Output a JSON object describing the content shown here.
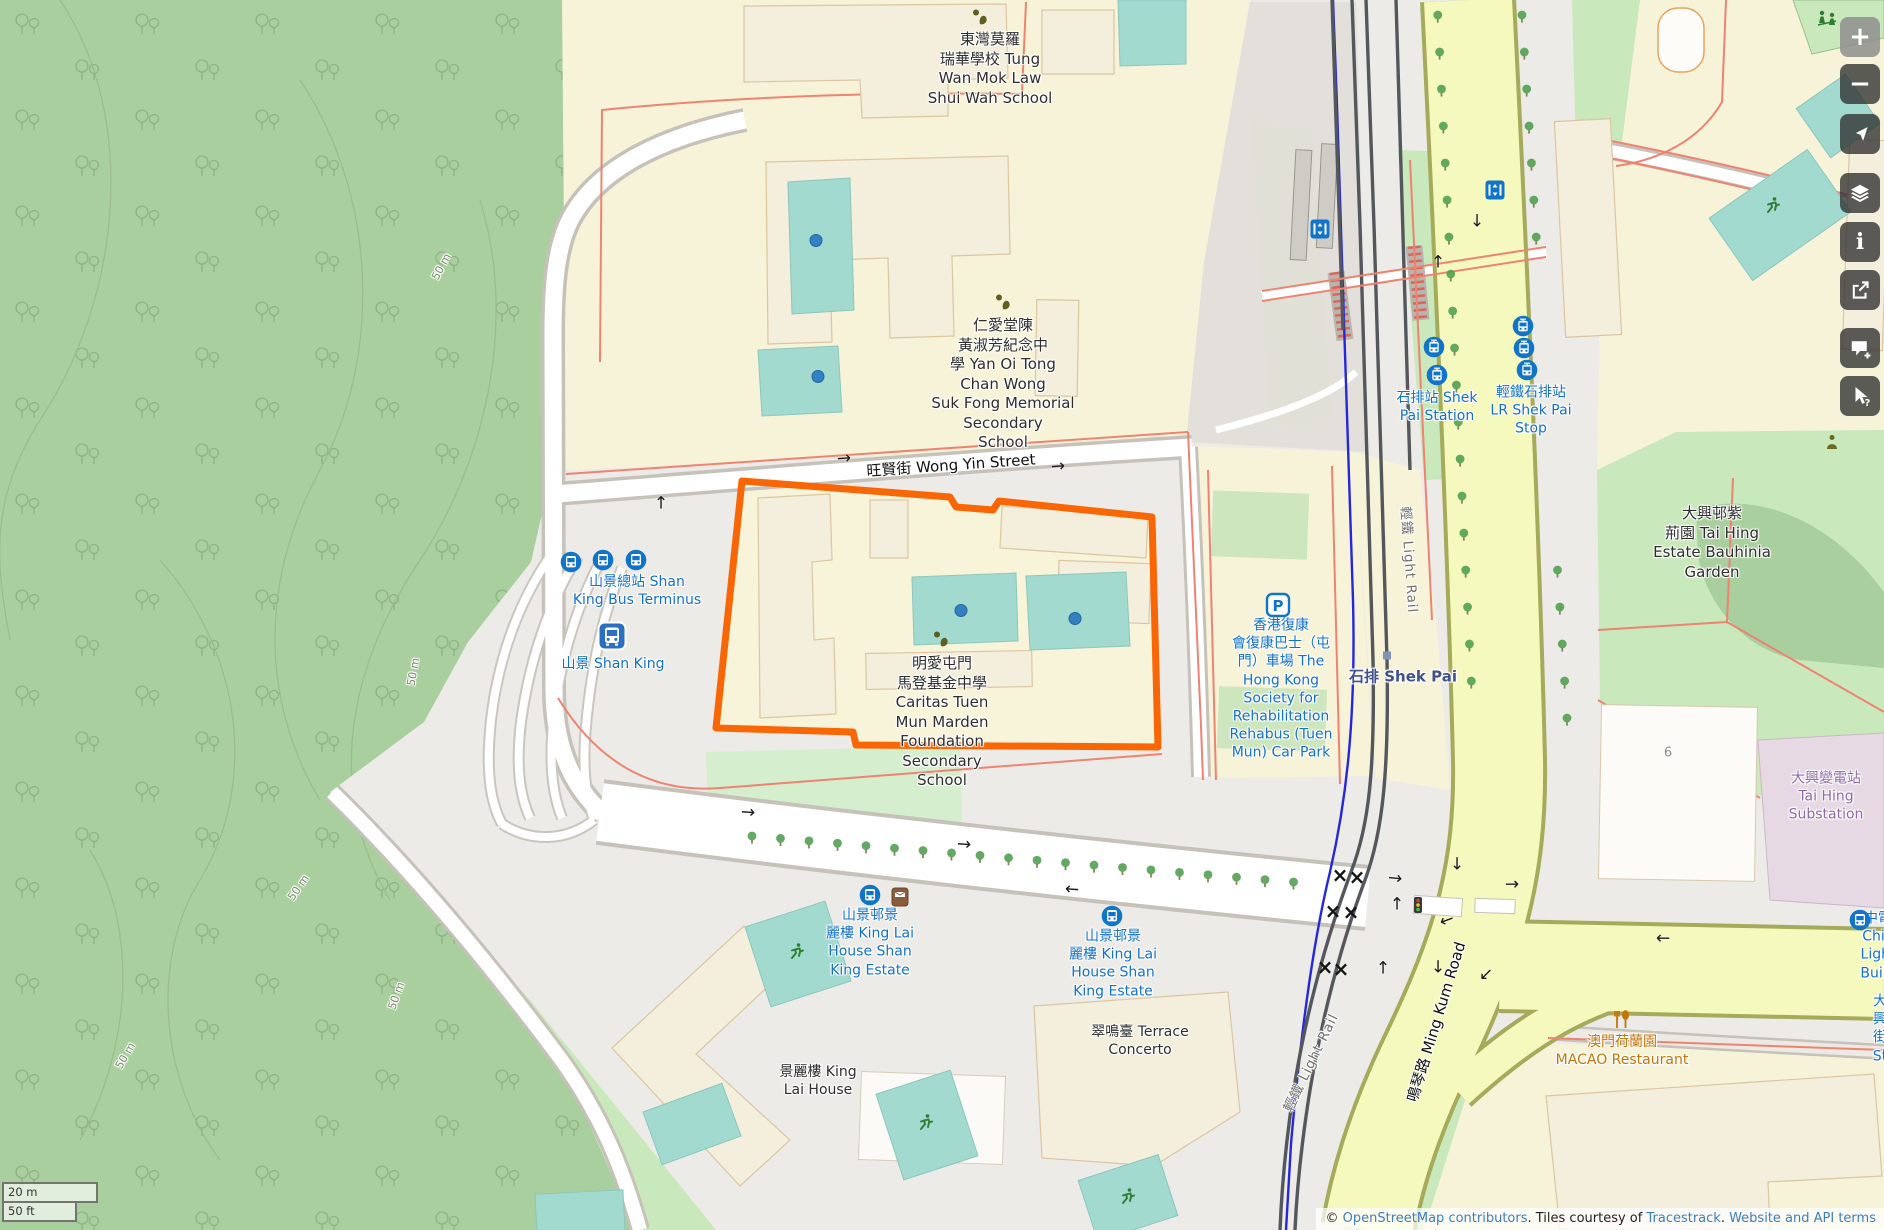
{
  "map": {
    "selection_color": "#f96605",
    "scale_bar": {
      "metric": "20 m",
      "imperial": "50 ft"
    },
    "attribution": {
      "prefix": "© ",
      "osm_link": "OpenStreetMap contributors",
      "middle": ". Tiles courtesy of ",
      "tracestrack_link": "Tracestrack",
      "period": ". ",
      "terms_link": "Website and API terms"
    },
    "labels": [
      {
        "n": "tung-wan-school",
        "t": "東灣莫羅\n瑞華學校 Tung\nWan Mok Law\nShui Wah School",
        "x": 990,
        "y": 69,
        "c": "poi"
      },
      {
        "n": "yan-oi-school",
        "t": "仁愛堂陳\n黃淑芳紀念中\n學 Yan Oi Tong\nChan Wong\nSuk Fong Memorial\nSecondary\nSchool",
        "x": 1003,
        "y": 384,
        "c": "poi"
      },
      {
        "n": "caritas-school",
        "t": "明愛屯門\n馬登基金中學\nCaritas Tuen\nMun Marden\nFoundation\nSecondary\nSchool",
        "x": 942,
        "y": 722,
        "c": "poi"
      },
      {
        "n": "shan-king-bus-terminus",
        "t": "山景總站 Shan\nKing Bus Terminus",
        "x": 637,
        "y": 591,
        "c": "transit"
      },
      {
        "n": "shan-king-station",
        "t": "山景 Shan King",
        "x": 613,
        "y": 664,
        "c": "transit"
      },
      {
        "n": "rehabus-car-park",
        "t": "香港復康\n會復康巴士（屯\n門）車場 The\nHong Kong\nSociety for\nRehabilitation\nRehabus (Tuen\nMun) Car Park",
        "x": 1281,
        "y": 689,
        "c": "transit"
      },
      {
        "n": "shek-pai-station",
        "t": "石排站 Shek\nPai Station",
        "x": 1437,
        "y": 407,
        "c": "transit"
      },
      {
        "n": "lr-shek-pai-stop",
        "t": "輕鐵石排站\nLR Shek Pai\nStop",
        "x": 1531,
        "y": 411,
        "c": "transit"
      },
      {
        "n": "shek-pai-place",
        "t": "石排 Shek Pai",
        "x": 1403,
        "y": 677,
        "c": "place"
      },
      {
        "n": "tai-hing-estate-garden",
        "t": "大興邨紫\n荊園 Tai Hing\nEstate Bauhinia\nGarden",
        "x": 1712,
        "y": 543,
        "c": "poi"
      },
      {
        "n": "tai-hing-substation",
        "t": "大興變電站\nTai Hing Substation",
        "x": 1826,
        "y": 797,
        "c": "power"
      },
      {
        "n": "macao-restaurant",
        "t": "澳門荷蘭園\nMACAO Restaurant",
        "x": 1622,
        "y": 1051,
        "c": "food"
      },
      {
        "n": "king-lai-bus-stop-west",
        "t": "山景邨景\n麗樓 King Lai\nHouse Shan\nKing Estate",
        "x": 870,
        "y": 943,
        "c": "transit"
      },
      {
        "n": "king-lai-bus-stop-east",
        "t": "山景邨景\n麗樓 King Lai\nHouse Shan\nKing Estate",
        "x": 1113,
        "y": 964,
        "c": "transit"
      },
      {
        "n": "terrace-concerto",
        "t": "翠鳴臺 Terrace\nConcerto",
        "x": 1140,
        "y": 1041,
        "c": "poi",
        "fs": 14
      },
      {
        "n": "king-lai-house",
        "t": "景麗樓 King\nLai House",
        "x": 818,
        "y": 1081,
        "c": "poi",
        "fs": 14
      },
      {
        "n": "light-rail-north",
        "t": "輕鐵 Light Rail",
        "x": 1408,
        "y": 560,
        "c": "rail",
        "r": 86
      },
      {
        "n": "light-rail-south",
        "t": "輕鐵 Light Rail",
        "x": 1312,
        "y": 1063,
        "c": "rail",
        "r": -64
      },
      {
        "n": "ming-kum-road",
        "t": "鳴琴路 Ming Kum Road",
        "x": 1437,
        "y": 1022,
        "c": "road",
        "r": -73
      },
      {
        "n": "wong-yin-street",
        "t": "旺賢街 Wong Yin Street",
        "x": 951,
        "y": 466,
        "c": "road",
        "r": -4
      },
      {
        "n": "house-number-6",
        "t": "6",
        "x": 1668,
        "y": 754,
        "c": "muted"
      },
      {
        "n": "clp-light-building",
        "t": "中電 Chin\nLight Build",
        "x": 1878,
        "y": 946,
        "c": "transit"
      },
      {
        "n": "tai-hing-street",
        "t": "大興街\nSt",
        "x": 1880,
        "y": 1029,
        "c": "transit"
      },
      {
        "n": "contour-50m-1",
        "t": "50 m",
        "x": 442,
        "y": 267,
        "c": "contour",
        "r": -62
      },
      {
        "n": "contour-50m-2",
        "t": "50 m",
        "x": 414,
        "y": 672,
        "c": "contour",
        "r": -80
      },
      {
        "n": "contour-50m-3",
        "t": "50 m",
        "x": 299,
        "y": 888,
        "c": "contour",
        "r": -55
      },
      {
        "n": "contour-50m-4",
        "t": "50 m",
        "x": 397,
        "y": 996,
        "c": "contour",
        "r": -70
      },
      {
        "n": "contour-50m-5",
        "t": "50 m",
        "x": 126,
        "y": 1056,
        "c": "contour",
        "r": -60
      }
    ],
    "icons": [
      {
        "t": "bus-stop",
        "x": 571,
        "y": 564
      },
      {
        "t": "bus-stop",
        "x": 603,
        "y": 562
      },
      {
        "t": "bus-stop",
        "x": 636,
        "y": 562
      },
      {
        "t": "bus-stop",
        "x": 870,
        "y": 897
      },
      {
        "t": "bus-stop",
        "x": 1112,
        "y": 918
      },
      {
        "t": "bus-stop",
        "x": 1860,
        "y": 922
      },
      {
        "t": "tram-stop",
        "x": 1434,
        "y": 349
      },
      {
        "t": "tram-stop",
        "x": 1437,
        "y": 377
      },
      {
        "t": "tram-stop",
        "x": 1523,
        "y": 328
      },
      {
        "t": "tram-stop",
        "x": 1524,
        "y": 350
      },
      {
        "t": "tram-stop",
        "x": 1527,
        "y": 372
      },
      {
        "t": "bus-station",
        "x": 612,
        "y": 638
      },
      {
        "t": "parking",
        "x": 1278,
        "y": 607
      },
      {
        "t": "elevator",
        "x": 1320,
        "y": 231
      },
      {
        "t": "elevator",
        "x": 1495,
        "y": 192
      },
      {
        "t": "postbox",
        "x": 900,
        "y": 899
      },
      {
        "t": "school",
        "x": 980,
        "y": 18
      },
      {
        "t": "school",
        "x": 1003,
        "y": 303
      },
      {
        "t": "school",
        "x": 941,
        "y": 640
      },
      {
        "t": "restaurant",
        "x": 1622,
        "y": 1022
      },
      {
        "t": "runner",
        "x": 797,
        "y": 953
      },
      {
        "t": "runner",
        "x": 926,
        "y": 1124
      },
      {
        "t": "runner",
        "x": 1128,
        "y": 1198
      },
      {
        "t": "runner",
        "x": 1773,
        "y": 207
      },
      {
        "t": "playground",
        "x": 1827,
        "y": 20
      },
      {
        "t": "social",
        "x": 1832,
        "y": 444
      },
      {
        "t": "traffic-light",
        "x": 1418,
        "y": 907
      },
      {
        "t": "pitch-dot",
        "x": 816,
        "y": 242
      },
      {
        "t": "pitch-dot",
        "x": 818,
        "y": 378
      },
      {
        "t": "pitch-dot",
        "x": 961,
        "y": 612
      },
      {
        "t": "pitch-dot",
        "x": 1075,
        "y": 620
      },
      {
        "t": "place-dot",
        "x": 1387,
        "y": 655
      },
      {
        "t": "crossing",
        "x": 1340,
        "y": 875
      },
      {
        "t": "crossing",
        "x": 1357,
        "y": 877
      },
      {
        "t": "crossing",
        "x": 1333,
        "y": 911
      },
      {
        "t": "crossing",
        "x": 1351,
        "y": 912
      },
      {
        "t": "crossing",
        "x": 1325,
        "y": 967
      },
      {
        "t": "crossing",
        "x": 1341,
        "y": 969
      }
    ],
    "arrows": [
      {
        "g": "→",
        "x": 844,
        "y": 459,
        "r": -4
      },
      {
        "g": "→",
        "x": 1058,
        "y": 467,
        "r": -4
      },
      {
        "g": "↑",
        "x": 661,
        "y": 504,
        "r": 0
      },
      {
        "g": "→",
        "x": 748,
        "y": 813,
        "r": 4
      },
      {
        "g": "→",
        "x": 964,
        "y": 845,
        "r": 4
      },
      {
        "g": "←",
        "x": 1072,
        "y": 890,
        "r": 4
      },
      {
        "g": "→",
        "x": 1395,
        "y": 879,
        "r": 6
      },
      {
        "g": "↑",
        "x": 1397,
        "y": 905,
        "r": 0
      },
      {
        "g": "↑",
        "x": 1383,
        "y": 969,
        "r": 0
      },
      {
        "g": "↓",
        "x": 1457,
        "y": 865,
        "r": 0
      },
      {
        "g": "→",
        "x": 1512,
        "y": 885,
        "r": 0
      },
      {
        "g": "←",
        "x": 1447,
        "y": 921,
        "r": -20
      },
      {
        "g": "↓",
        "x": 1438,
        "y": 968,
        "r": 0
      },
      {
        "g": "↙",
        "x": 1486,
        "y": 975,
        "r": 0
      },
      {
        "g": "↓",
        "x": 1477,
        "y": 222,
        "r": 0
      },
      {
        "g": "↑",
        "x": 1438,
        "y": 263,
        "r": 0
      },
      {
        "g": "←",
        "x": 1663,
        "y": 939,
        "r": 0
      }
    ],
    "controls": [
      {
        "n": "zoom-in",
        "glyph": "plus",
        "y": 17,
        "light": true
      },
      {
        "n": "zoom-out",
        "glyph": "minus",
        "y": 64
      },
      {
        "n": "locate",
        "glyph": "locate",
        "y": 114
      },
      {
        "n": "layers",
        "glyph": "layers",
        "y": 173
      },
      {
        "n": "info",
        "glyph": "info",
        "y": 222
      },
      {
        "n": "share",
        "glyph": "share",
        "y": 270
      },
      {
        "n": "add-note",
        "glyph": "note",
        "y": 328
      },
      {
        "n": "query",
        "glyph": "query",
        "y": 376
      }
    ]
  }
}
